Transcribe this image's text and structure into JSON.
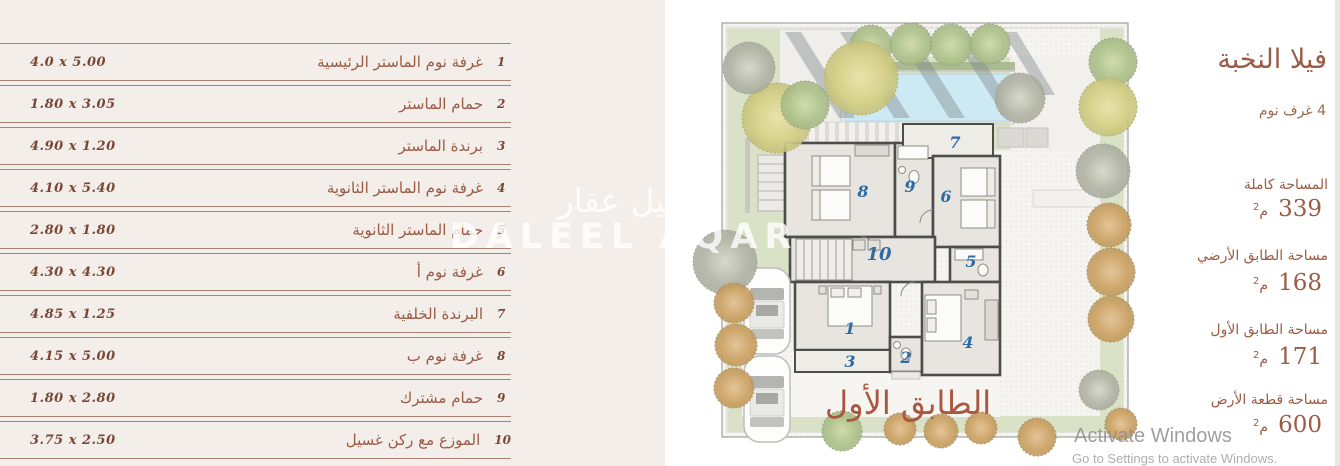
{
  "table": {
    "rows": [
      {
        "num": "1",
        "name": "غرفة نوم الماستر الرئيسية",
        "dims": "4.0 x 5.00"
      },
      {
        "num": "2",
        "name": "حمام الماستر",
        "dims": "1.80 x 3.05"
      },
      {
        "num": "3",
        "name": "برندة الماستر",
        "dims": "4.90 x 1.20"
      },
      {
        "num": "4",
        "name": "غرفة نوم الماستر الثانوية",
        "dims": "4.10 x 5.40"
      },
      {
        "num": "5",
        "name": "حمام الماستر الثانوية",
        "dims": "2.80 x 1.80"
      },
      {
        "num": "6",
        "name": "غرفة نوم أ",
        "dims": "4.30 x 4.30"
      },
      {
        "num": "7",
        "name": "البرندة الخلفية",
        "dims": "4.85 x 1.25"
      },
      {
        "num": "8",
        "name": "غرفة نوم ب",
        "dims": "4.15 x 5.00"
      },
      {
        "num": "9",
        "name": "حمام مشترك",
        "dims": "1.80 x 2.80"
      },
      {
        "num": "10",
        "name": "الموزع مع ركن غسيل",
        "dims": "3.75 x 2.50"
      }
    ]
  },
  "plan": {
    "caption": "الطابق الأول",
    "rooms": [
      "1",
      "2",
      "3",
      "4",
      "5",
      "6",
      "7",
      "8",
      "9",
      "10"
    ],
    "watermark_ar": "دليل عقار",
    "watermark_en": "DALEEL AQAR"
  },
  "info": {
    "title": "فيلا النخبة",
    "subtitle": "4 غرف نوم",
    "areas": [
      {
        "label": "المساحة كاملة",
        "value": "339",
        "unit": "م",
        "sup": "2"
      },
      {
        "label": "مساحة الطابق الأرضي",
        "value": "168",
        "unit": "م",
        "sup": "2"
      },
      {
        "label": "مساحة الطابق الأول",
        "value": "171",
        "unit": "م",
        "sup": "2"
      },
      {
        "label": "مساحة قطعة الأرض",
        "value": "600",
        "unit": "م",
        "sup": "2"
      }
    ]
  },
  "os_watermark": {
    "line1": "Activate Windows",
    "line2": "Go to Settings to activate Windows."
  },
  "colors": {
    "panel_bg": "#f3eeea",
    "rule": "#aa8172",
    "brown_text": "#9a5a43",
    "accent_brown": "#9c5b44",
    "caption_brown": "#a9573f",
    "room_number_blue": "#2d6ca3",
    "pool_blue": "#cdeaf4"
  }
}
